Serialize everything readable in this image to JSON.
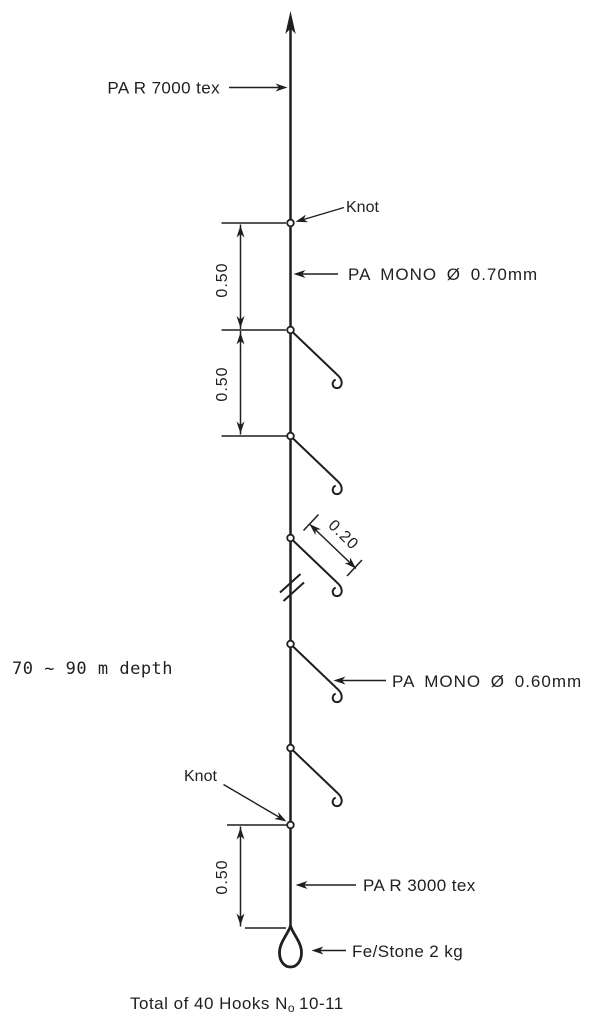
{
  "colors": {
    "ink": "#1f1f1f",
    "paper": "#ffffff"
  },
  "diagram": {
    "mainline_label": "PA R 7000 tex",
    "knot_label_upper": "Knot",
    "branch_label_upper": "PA MONO Ø 0.70mm",
    "branch_label_lower": "PA MONO Ø 0.60mm",
    "knot_label_lower": "Knot",
    "bottomline_label": "PA R 3000 tex",
    "sinker_label": "Fe/Stone 2 kg",
    "depth_note": "70 ~ 90 m depth",
    "dims": {
      "upper_1": "0.50",
      "upper_2": "0.50",
      "hook_spacing": "0.20",
      "lower": "0.50"
    },
    "caption": {
      "prefix": "Total of 40 Hooks N",
      "subscript": "o",
      "suffix": "10-11"
    }
  }
}
